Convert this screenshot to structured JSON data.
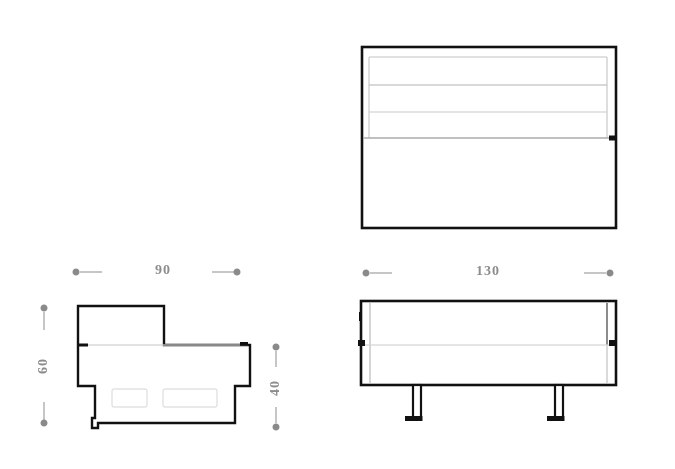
{
  "drawing": {
    "type": "furniture-orthographic-technical-drawing",
    "views": {
      "top": {
        "name": "top-view"
      },
      "side": {
        "name": "side-view"
      },
      "front": {
        "name": "front-view"
      }
    },
    "dimensions": {
      "side_width": {
        "value": "90"
      },
      "side_height": {
        "value": "60"
      },
      "seat_height": {
        "value": "40"
      },
      "front_width": {
        "value": "130"
      }
    },
    "colors": {
      "outline_black": "#111111",
      "dimension_text_gray": "#8c8c8c",
      "dimension_dot_gray": "#8a8a8a",
      "dimension_line_gray": "#c6c6c6",
      "detail_line_gray": "#cccccc"
    }
  }
}
